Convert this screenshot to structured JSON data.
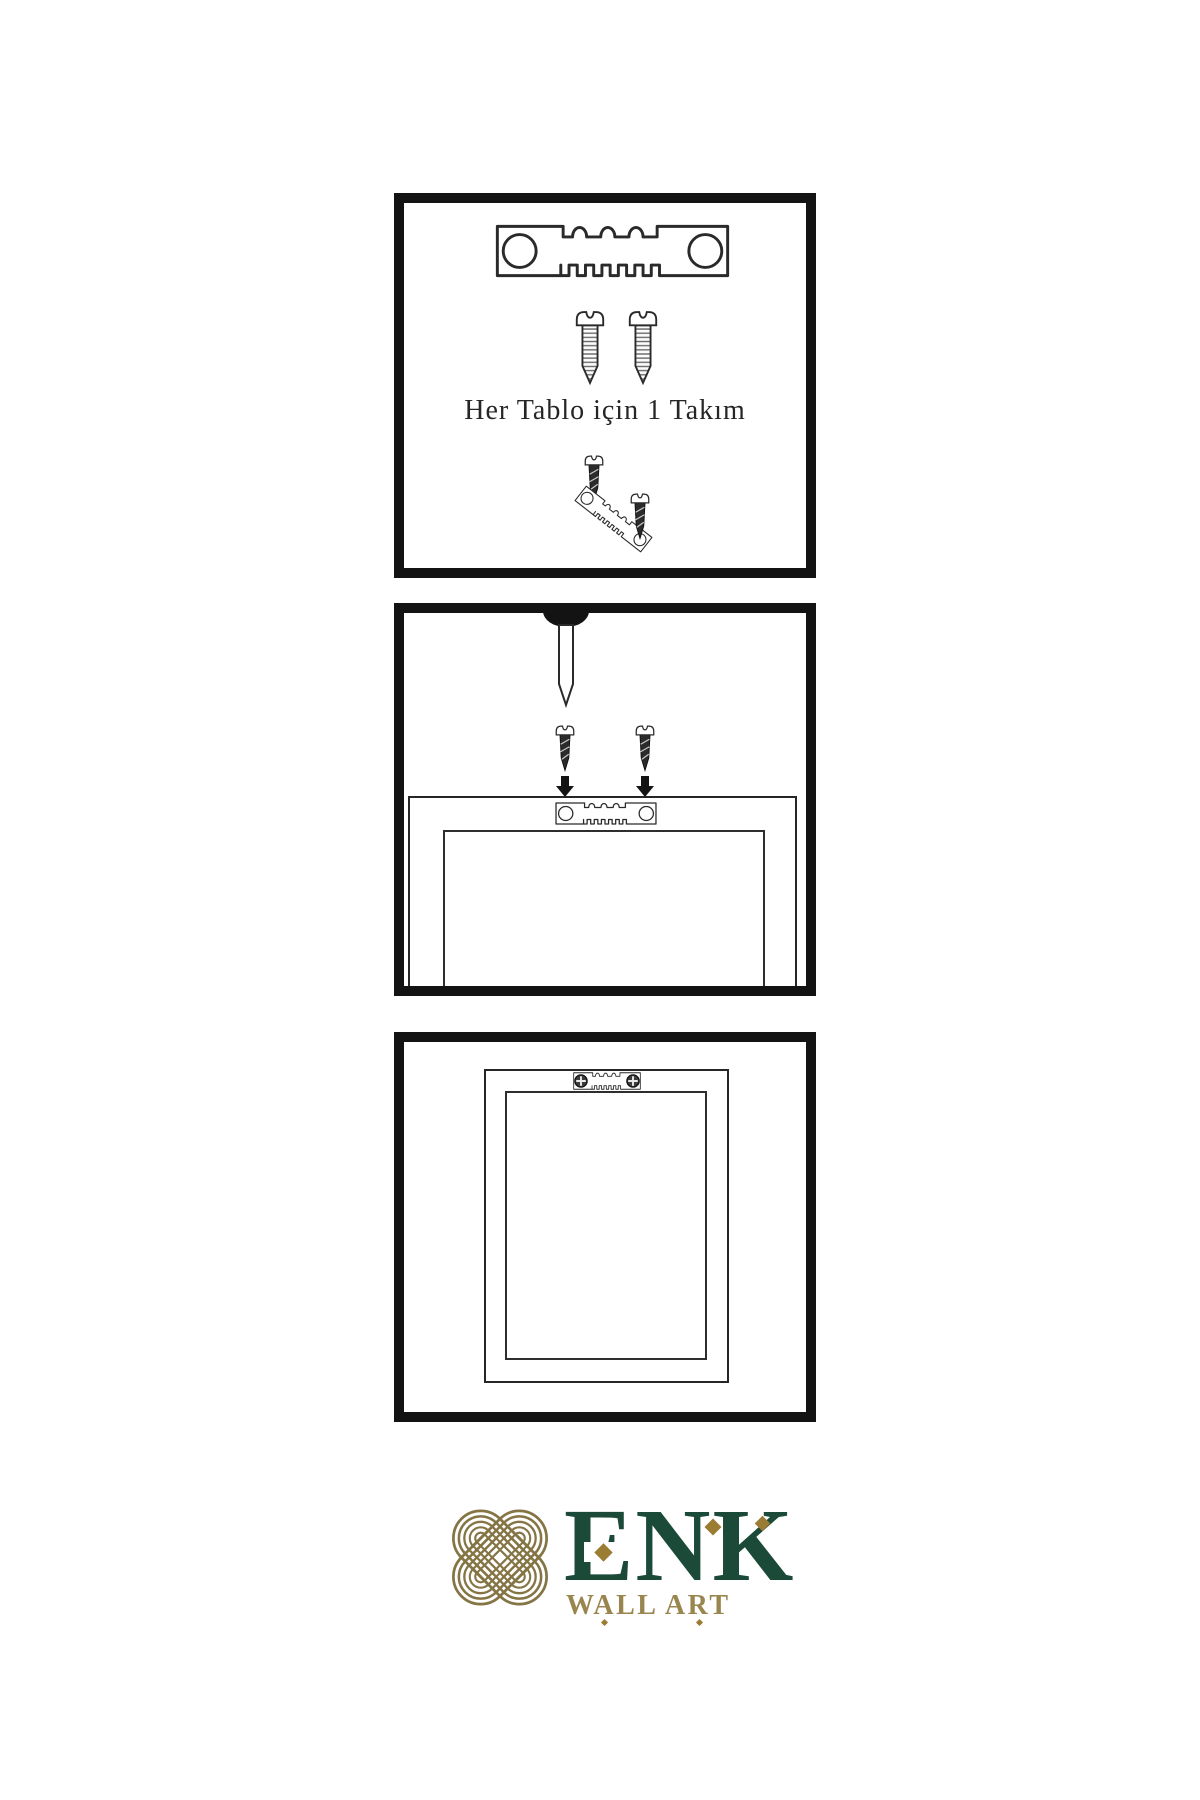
{
  "colors": {
    "ink": "#131313",
    "outline": "#2a2a2a",
    "brand_green": "#1c4a39",
    "brand_gold": "#9a7c33",
    "knot_gold": "#857545",
    "tagline_gold": "#99854e"
  },
  "panel_kit": {
    "caption": "Her Tablo için 1 Takım",
    "icons": [
      "sawtooth-hanger-icon",
      "screw-icon",
      "screw-icon",
      "screw-icon",
      "tilted-sawtooth-hanger-icon",
      "screw-icon"
    ]
  },
  "panel_install": {
    "icons": [
      "wall-nail-icon",
      "screw-icon",
      "screw-icon",
      "arrow-down-icon",
      "arrow-down-icon",
      "sawtooth-hanger-icon",
      "frame-back-outline"
    ]
  },
  "panel_hang": {
    "icons": [
      "frame-back-outline",
      "sawtooth-hanger-icon",
      "phillips-screw-icon",
      "phillips-screw-icon"
    ]
  },
  "logo": {
    "icon": "interlaced-knot-icon",
    "brand": "ENK",
    "tagline": "WALL ART"
  }
}
